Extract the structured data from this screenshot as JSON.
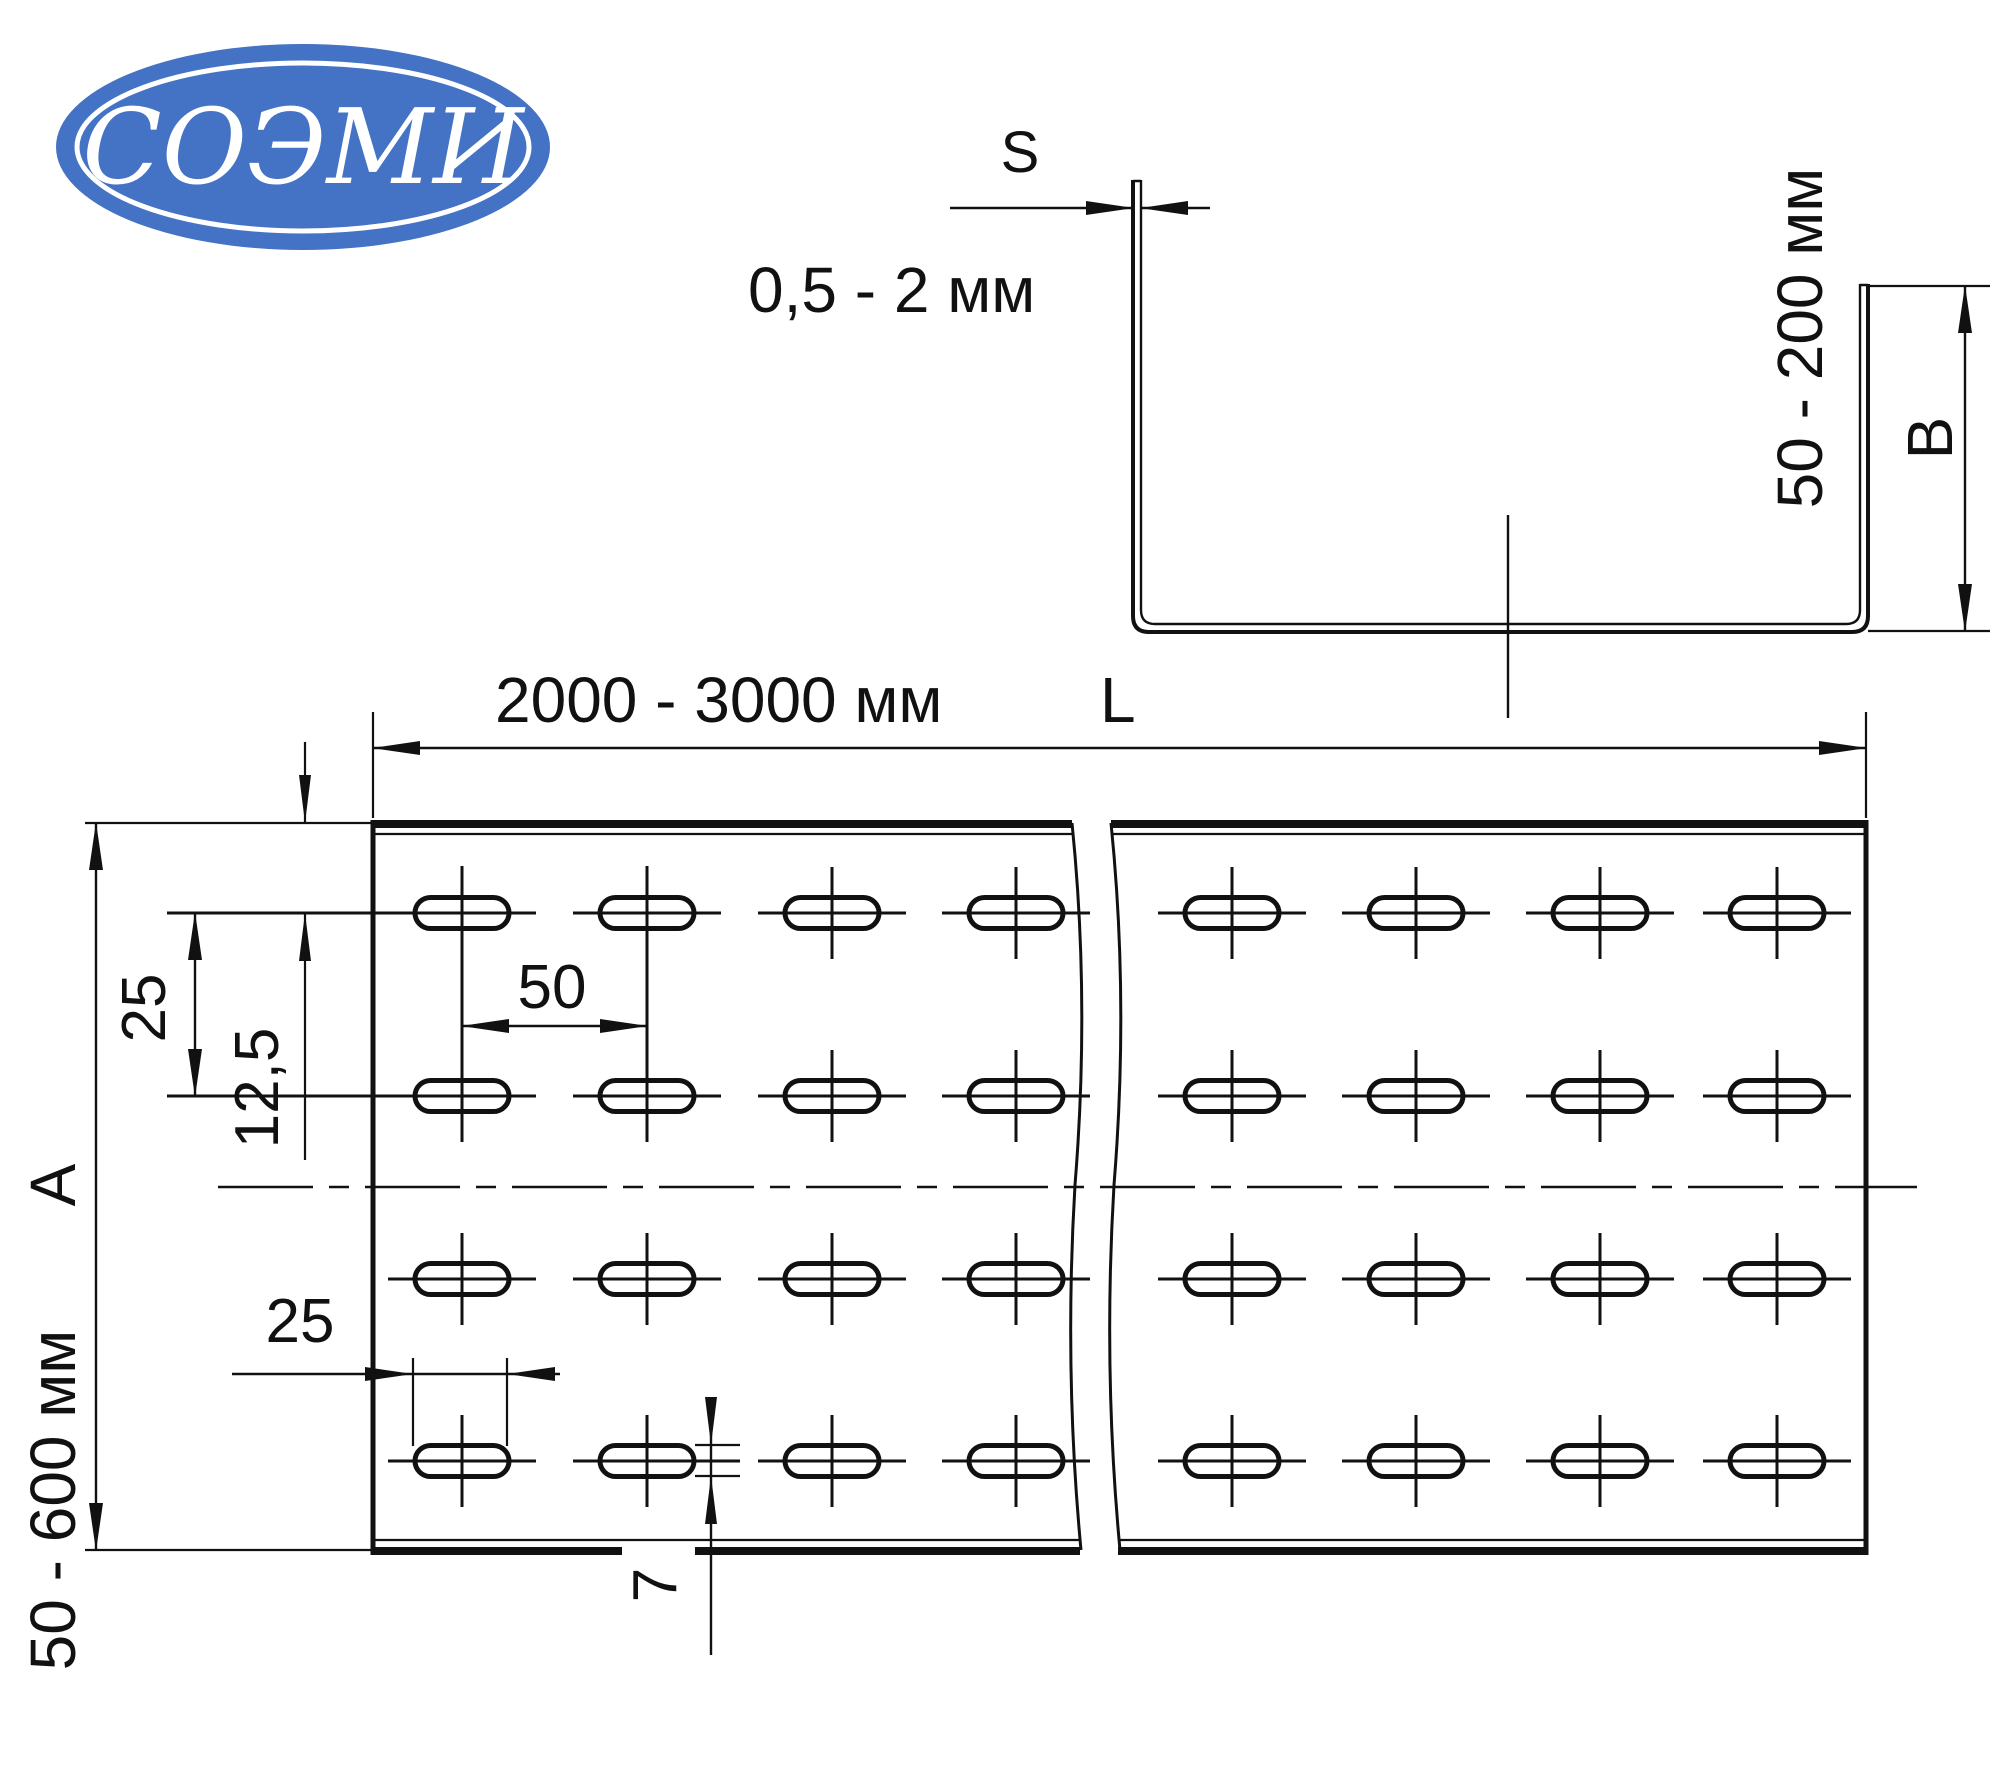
{
  "logo": {
    "text": "СОЭМИ",
    "bg_color": "#4472c4",
    "text_color": "#ffffff"
  },
  "drawing": {
    "line_color": "#111111",
    "background": "#ffffff"
  },
  "section_view": {
    "thickness_symbol": "S",
    "thickness_range": "0,5 - 2 мм",
    "height_range": "50 - 200 мм",
    "height_symbol": "B"
  },
  "plan_view": {
    "length_range": "2000 - 3000 мм",
    "length_symbol": "L",
    "width_range": "50 - 600 мм",
    "width_symbol": "A",
    "row_spacing": "25",
    "edge_offset": "12,5",
    "slot_pitch": "50",
    "slot_length": "25",
    "slot_width": "7",
    "slot_pattern": {
      "rows": [
        913,
        1096,
        1279,
        1461
      ],
      "columns_left": [
        462,
        647,
        832,
        1016
      ],
      "columns_right": [
        1232,
        1416,
        1600,
        1777
      ],
      "slot_width_px": 94,
      "slot_height_px": 31
    }
  }
}
